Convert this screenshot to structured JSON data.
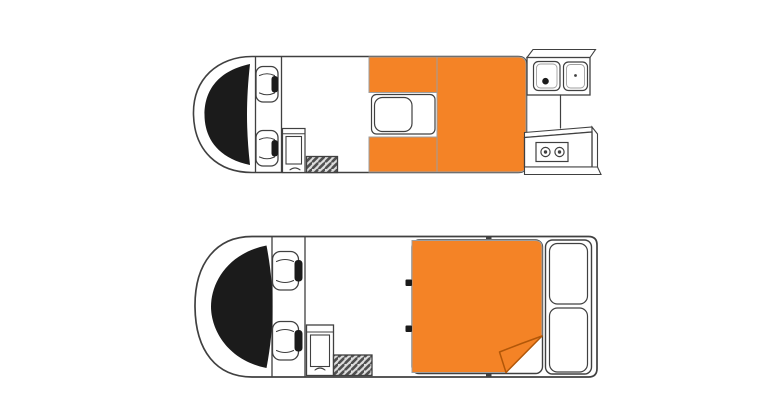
{
  "colors": {
    "background": "#ffffff",
    "white": "#ffffff",
    "line": "#404040",
    "dark": "#1b1b1b",
    "accent": "#f48326",
    "accent_outline": "#9e9e9e",
    "accent_edge": "#b25708",
    "hatch_bg": "#dcdcdc",
    "hatch_line": "#4f4f4f"
  },
  "icons": {
    "windshield-icon": "black crescent band",
    "cab-seat-icon": "rounded square with black headrest bar",
    "sink-icon": "rounded square with drain dot",
    "stove-knob-icon": "circle with center dot",
    "entry-step-icon": "diagonal hatched rectangle",
    "bed-fold-icon": "folded orange corner triangle"
  }
}
